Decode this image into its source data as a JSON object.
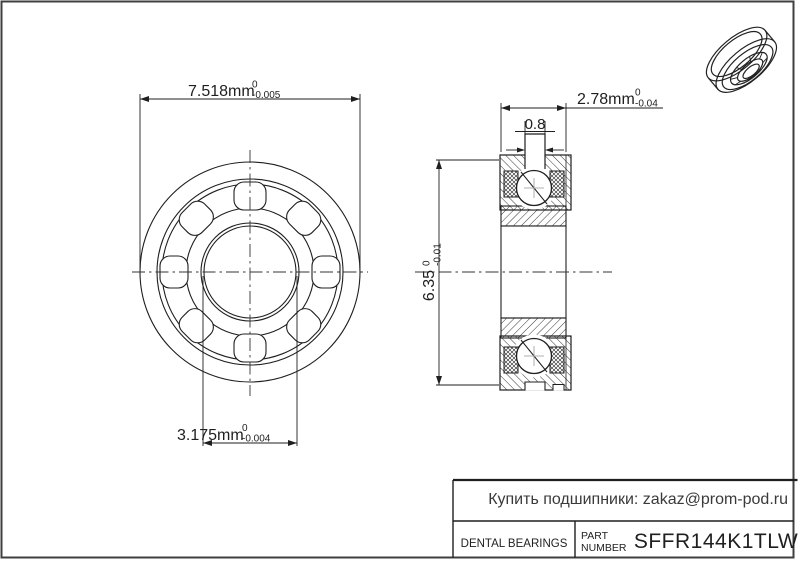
{
  "page": {
    "background": "#ffffff",
    "frame_color": "#3f3f3f",
    "line_color": "#1f1f1f"
  },
  "dimensions": {
    "flange_od": {
      "value": "7.518mm",
      "tol_upper": "0",
      "tol_lower": "-0.005"
    },
    "bore": {
      "value": "3.175mm",
      "tol_upper": "0",
      "tol_lower": "-0.004"
    },
    "width": {
      "value": "2.78mm",
      "tol_upper": "0",
      "tol_lower": "-0.04"
    },
    "flange_width": {
      "value": "0.8"
    },
    "outer_diameter": {
      "value": "6.35",
      "tol_upper": "0",
      "tol_lower": "-0.01"
    }
  },
  "title_block": {
    "category": "DENTAL BEARINGS",
    "part_label_line1": "PART",
    "part_label_line2": "NUMBER",
    "part_number": "SFFR144K1TLW",
    "contact": "Купить подшипники: zakaz@prom-pod.ru"
  }
}
